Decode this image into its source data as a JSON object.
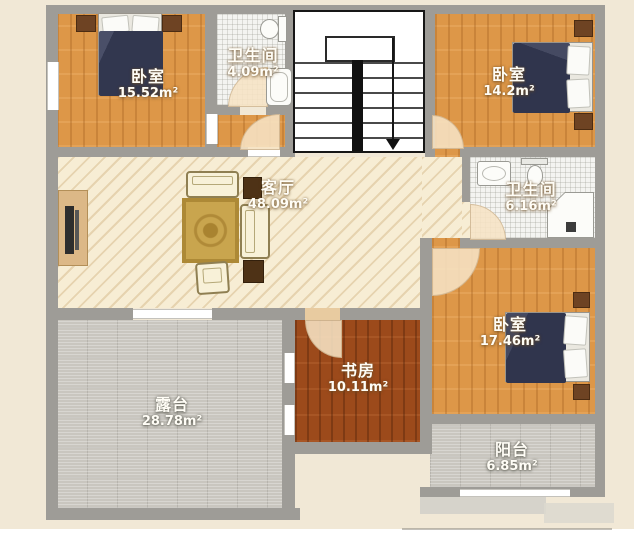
{
  "plan": {
    "type": "residential-floor-plan",
    "area_unit": "m²",
    "rooms": {
      "bedroom_top_left": {
        "name": "卧室",
        "area": "15.52m²"
      },
      "bathroom_top": {
        "name": "卫生间",
        "area": "4.09m²"
      },
      "bedroom_top_right": {
        "name": "卧室",
        "area": "14.2m²"
      },
      "living_room": {
        "name": "客厅",
        "area": "48.09m²"
      },
      "bathroom_right": {
        "name": "卫生间",
        "area": "6.16m²"
      },
      "bedroom_bottom_right": {
        "name": "卧室",
        "area": "17.46m²"
      },
      "study": {
        "name": "书房",
        "area": "10.11m²"
      },
      "terrace": {
        "name": "露台",
        "area": "28.78m²"
      },
      "balcony": {
        "name": "阳台",
        "area": "6.85m²"
      }
    },
    "colors": {
      "background_cream": "#f1e8d6",
      "wall_gray": "#9e9c97",
      "bedroom_wood": "#dd9748",
      "study_wood": "#9c4a1b",
      "living_hatch": "#f7edd4",
      "bathroom_tile": "#f4f4f1",
      "terrace_gray": "#c9c6bf",
      "bed_blanket_navy": "#32374f",
      "nightstand_brown": "#6e4323",
      "rug_gold": "#c9a54e",
      "label_text": "#fffdf6"
    }
  }
}
